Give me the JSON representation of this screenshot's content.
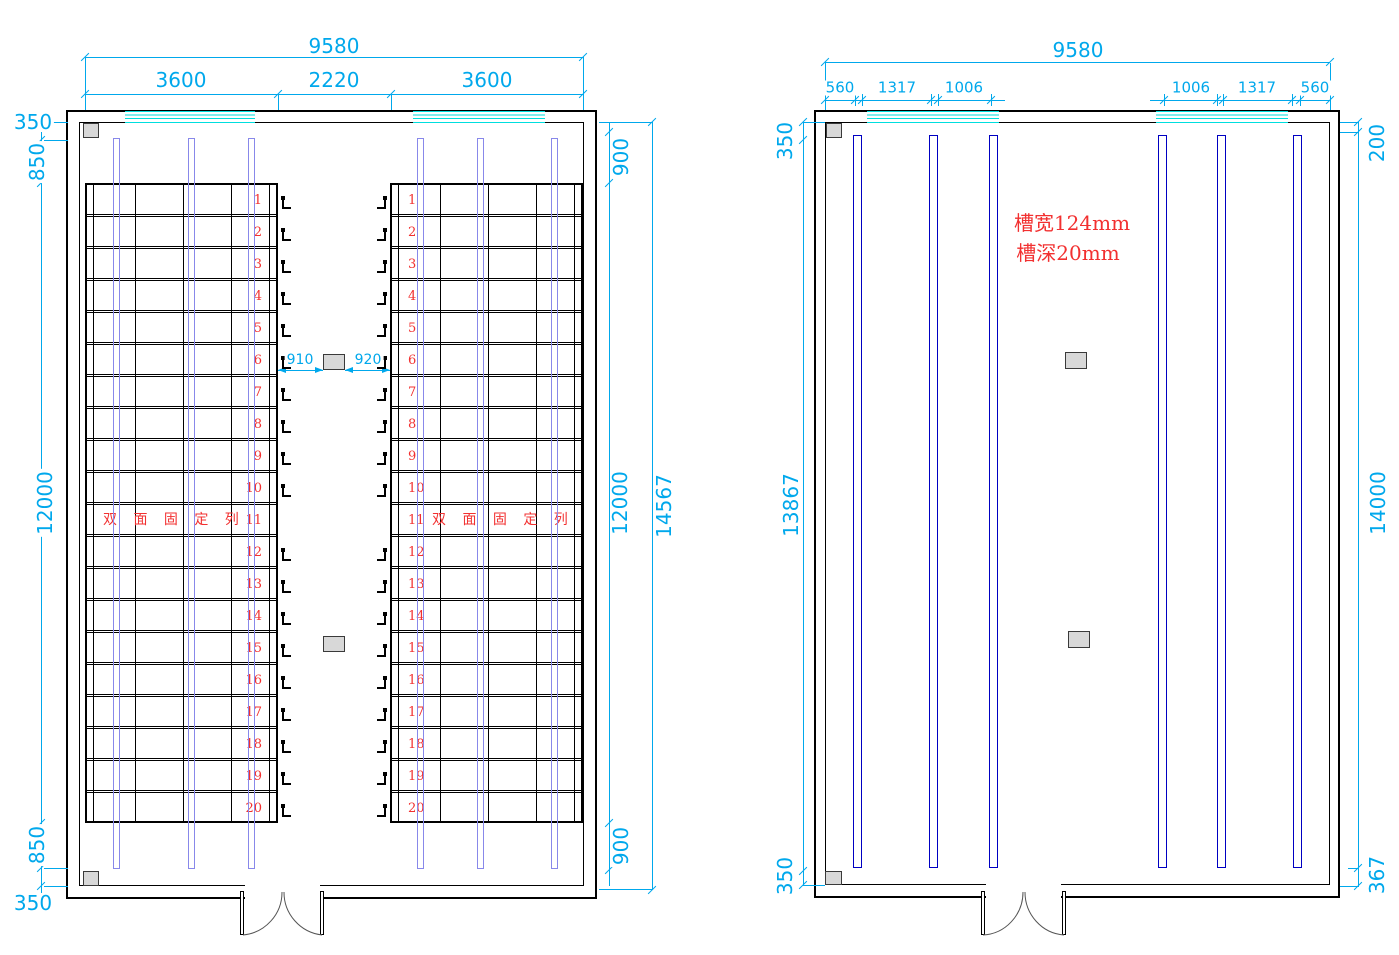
{
  "colors": {
    "dimension": "#00a8ec",
    "window": "#00dede",
    "rail_left_plan": "#8888ea",
    "rail_right_plan": "#0000c2",
    "red_annotation": "#f23030",
    "column_fill": "#d8d8d8"
  },
  "left_plan": {
    "overall_width": "9580",
    "top_segments": [
      "3600",
      "2220",
      "3600"
    ],
    "left_chain": [
      "350",
      "850",
      "12000",
      "850",
      "350"
    ],
    "right_chain": [
      "900",
      "12000",
      "900"
    ],
    "overall_height": "14567",
    "aisle_left": "910",
    "aisle_right": "920",
    "bank_label": "双 面 固 定 列",
    "row_count": 20,
    "row_numbers": [
      "1",
      "2",
      "3",
      "4",
      "5",
      "6",
      "7",
      "8",
      "9",
      "10",
      "11",
      "12",
      "13",
      "14",
      "15",
      "16",
      "17",
      "18",
      "19",
      "20"
    ]
  },
  "right_plan": {
    "overall_width": "9580",
    "top_left_segments": [
      "560",
      "1317",
      "1006"
    ],
    "top_right_segments": [
      "1006",
      "1317",
      "560"
    ],
    "left_chain": [
      "350",
      "13867",
      "350"
    ],
    "right_chain": [
      "200",
      "14000",
      "367"
    ],
    "notes": [
      "槽宽124mm",
      "槽深20mm"
    ]
  }
}
